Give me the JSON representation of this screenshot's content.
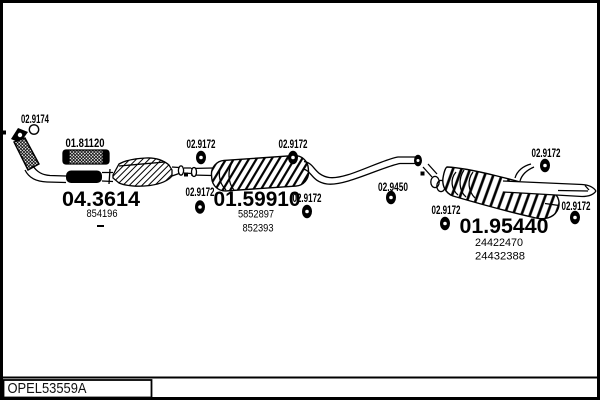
{
  "colors": {
    "ink": "#000000",
    "paper": "#ffffff"
  },
  "footer": {
    "code": "OPEL53559A"
  },
  "callouts": {
    "gasket": "02.9174",
    "flex_coupling": "01.81120",
    "hanger_top_left": "02.9172",
    "hanger_top_mid": "02.9172",
    "hanger_bottom_left": "02.9172",
    "hanger_bottom_mid": "02.9172",
    "bracket_link_pipe": "02.9450",
    "hanger_rear_top": "02.9172",
    "hanger_rear_inlet": "02.9172",
    "hanger_tailpipe": "02.9172"
  },
  "parts": {
    "front_pipe_number": "04.3614",
    "front_pipe_oem": "854196",
    "mid_muffler_number": "01.59910",
    "mid_muffler_oem1": "5852897",
    "mid_muffler_oem2": "852393",
    "rear_muffler_number": "01.95440",
    "rear_muffler_oem1": "24422470",
    "rear_muffler_oem2": "24432388"
  }
}
